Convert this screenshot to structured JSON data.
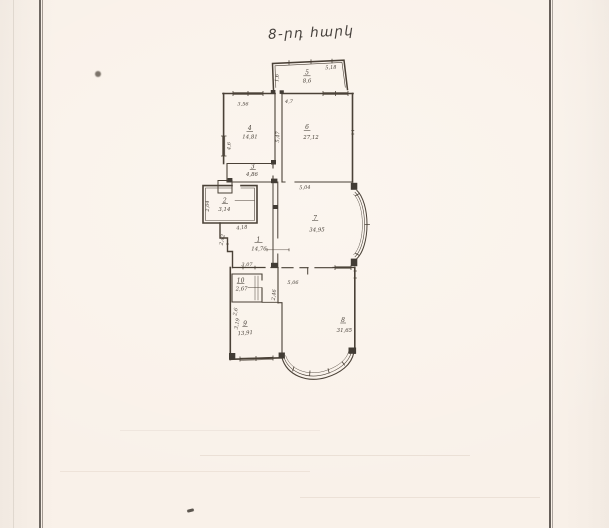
{
  "page": {
    "title": "8-րդ հարկ"
  },
  "plan": {
    "rooms": [
      {
        "num": "1",
        "area": "14,76"
      },
      {
        "num": "2",
        "area": "3,14"
      },
      {
        "num": "3",
        "area": "4,86"
      },
      {
        "num": "4",
        "area": "14,81"
      },
      {
        "num": "5",
        "area": "8,6"
      },
      {
        "num": "6",
        "area": "27,12"
      },
      {
        "num": "7",
        "area": "34,95"
      },
      {
        "num": "8",
        "area": "31,65"
      },
      {
        "num": "9",
        "area": "13,91"
      },
      {
        "num": "10",
        "area": "2,67"
      }
    ],
    "dims": {
      "w_top": "5,18",
      "r5_left": "1,6",
      "r4_top": "3,56",
      "r5_bottom": "4,7",
      "mid_vert": "5,47",
      "r4_left": "4,6",
      "hall_top": "5,04",
      "r2_left": "2,04",
      "r2_bottom": "4,18",
      "hall_left": "2,42",
      "hall_bottom": "3,07",
      "r8_top": "5,06",
      "r10_right": "2,46",
      "r9_left_upper": "2,6",
      "r9_left_lower": "3,19"
    }
  }
}
